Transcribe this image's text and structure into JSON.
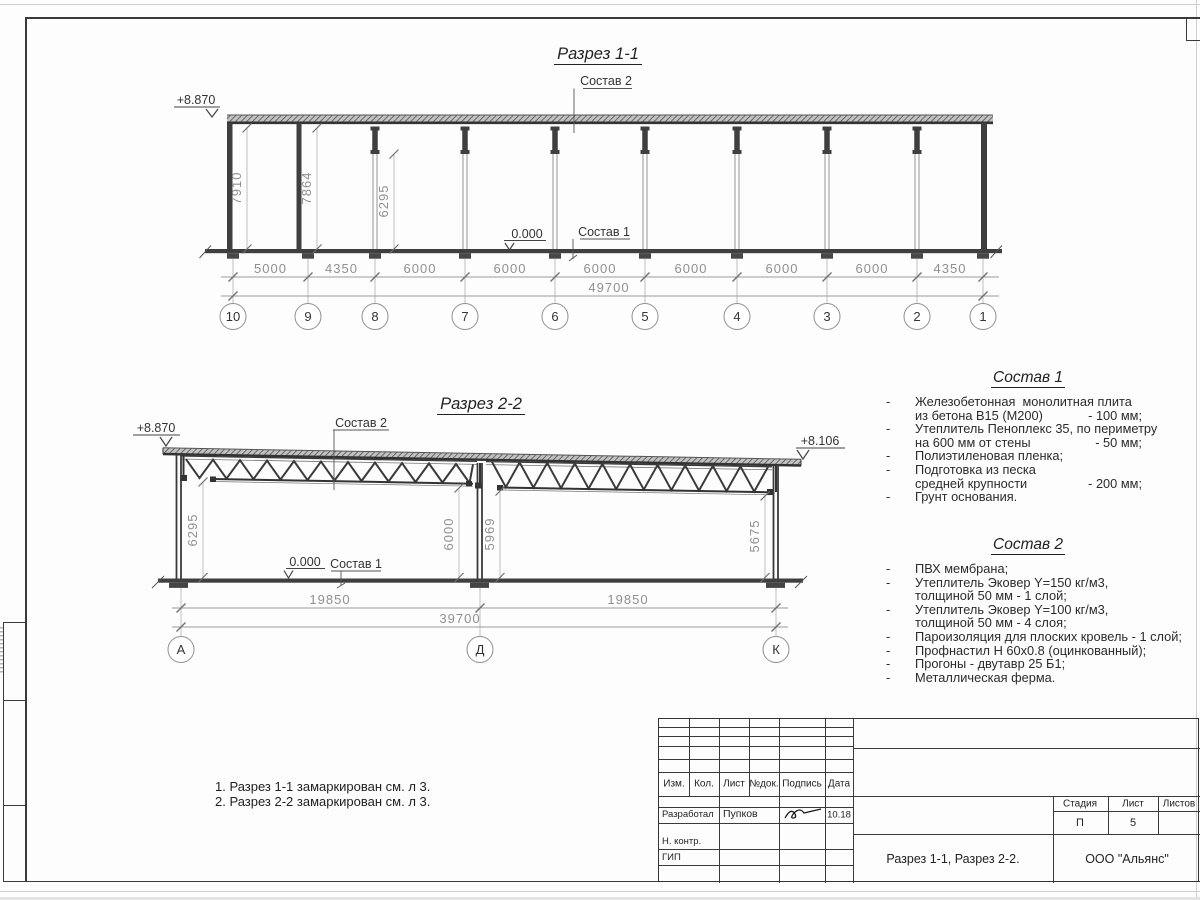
{
  "callouts": {
    "sostav1": "Состав 1",
    "sostav2": "Состав 2"
  },
  "section1": {
    "title": "Разрез 1-1",
    "elevation_top": "+8.870",
    "elevation_zero": "0.000",
    "vert_dims": [
      "7910",
      "7864",
      "6295"
    ],
    "span_dims": [
      "5000",
      "4350",
      "6000",
      "6000",
      "6000",
      "6000",
      "6000",
      "6000",
      "4350"
    ],
    "total_dim": "49700",
    "grid_labels": [
      "10",
      "9",
      "8",
      "7",
      "6",
      "5",
      "4",
      "3",
      "2",
      "1"
    ]
  },
  "section2": {
    "title": "Разрез 2-2",
    "elevation_left": "+8.870",
    "elevation_right": "+8.106",
    "elevation_zero": "0.000",
    "vert_dims": [
      "6295",
      "6000",
      "5969",
      "5675"
    ],
    "span_dims": [
      "19850",
      "19850"
    ],
    "total_dim": "39700",
    "grid_labels": [
      "А",
      "Д",
      "К"
    ]
  },
  "sostav1": {
    "title": "Состав 1",
    "rows": [
      {
        "dash": "-",
        "text": "Железобетонная  монолитная плита",
        "value": ""
      },
      {
        "dash": "",
        "text": "из бетона В15 (М200)",
        "value": "- 100 мм;"
      },
      {
        "dash": "-",
        "text": "Утеплитель Пеноплекс 35, по периметру",
        "value": ""
      },
      {
        "dash": "",
        "text": "на 600 мм от стены",
        "value": "- 50 мм;"
      },
      {
        "dash": "-",
        "text": "Полиэтиленовая пленка;",
        "value": ""
      },
      {
        "dash": "-",
        "text": "Подготовка из песка",
        "value": ""
      },
      {
        "dash": "",
        "text": "средней крупности",
        "value": "- 200 мм;"
      },
      {
        "dash": "-",
        "text": "Грунт основания.",
        "value": ""
      }
    ]
  },
  "sostav2": {
    "title": "Состав 2",
    "rows": [
      {
        "dash": "-",
        "text": "ПВХ мембрана;",
        "value": ""
      },
      {
        "dash": "-",
        "text": "Утеплитель Эковер Y=150 кг/м3,",
        "value": ""
      },
      {
        "dash": "",
        "text": "толщиной 50 мм - 1 слой;",
        "value": ""
      },
      {
        "dash": "-",
        "text": "Утеплитель Эковер Y=100 кг/м3,",
        "value": ""
      },
      {
        "dash": "",
        "text": "толщиной 50 мм - 4 слоя;",
        "value": ""
      },
      {
        "dash": "-",
        "text": "Пароизоляция для плоских кровель - 1 слой;",
        "value": ""
      },
      {
        "dash": "-",
        "text": "Профнастил Н 60х0.8 (оцинкованный);",
        "value": ""
      },
      {
        "dash": "-",
        "text": "Прогоны - двутавр 25 Б1;",
        "value": ""
      },
      {
        "dash": "-",
        "text": "Металлическая ферма.",
        "value": ""
      }
    ]
  },
  "notes": {
    "line1": "1. Разрез 1-1 замаркирован см. л 3.",
    "line2": "2. Разрез 2-2 замаркирован см. л 3."
  },
  "titleblock": {
    "headers": {
      "izm": "Изм.",
      "kol": "Кол.",
      "list": "Лист",
      "ndok": "№док.",
      "podpis": "Подпись",
      "data": "Дата"
    },
    "razrabotal_label": "Разработал",
    "razrabotal_name": "Пупков",
    "razrabotal_date": "10.18",
    "nkontr_label": "Н. контр.",
    "gip_label": "ГИП",
    "doc_title": "Разрез 1-1, Разрез 2-2.",
    "stadia_label": "Стадия",
    "list_label": "Лист",
    "listov_label": "Листов",
    "stadia_value": "П",
    "list_value": "5",
    "listov_value": "",
    "company": "ООО \"Альянс\""
  }
}
